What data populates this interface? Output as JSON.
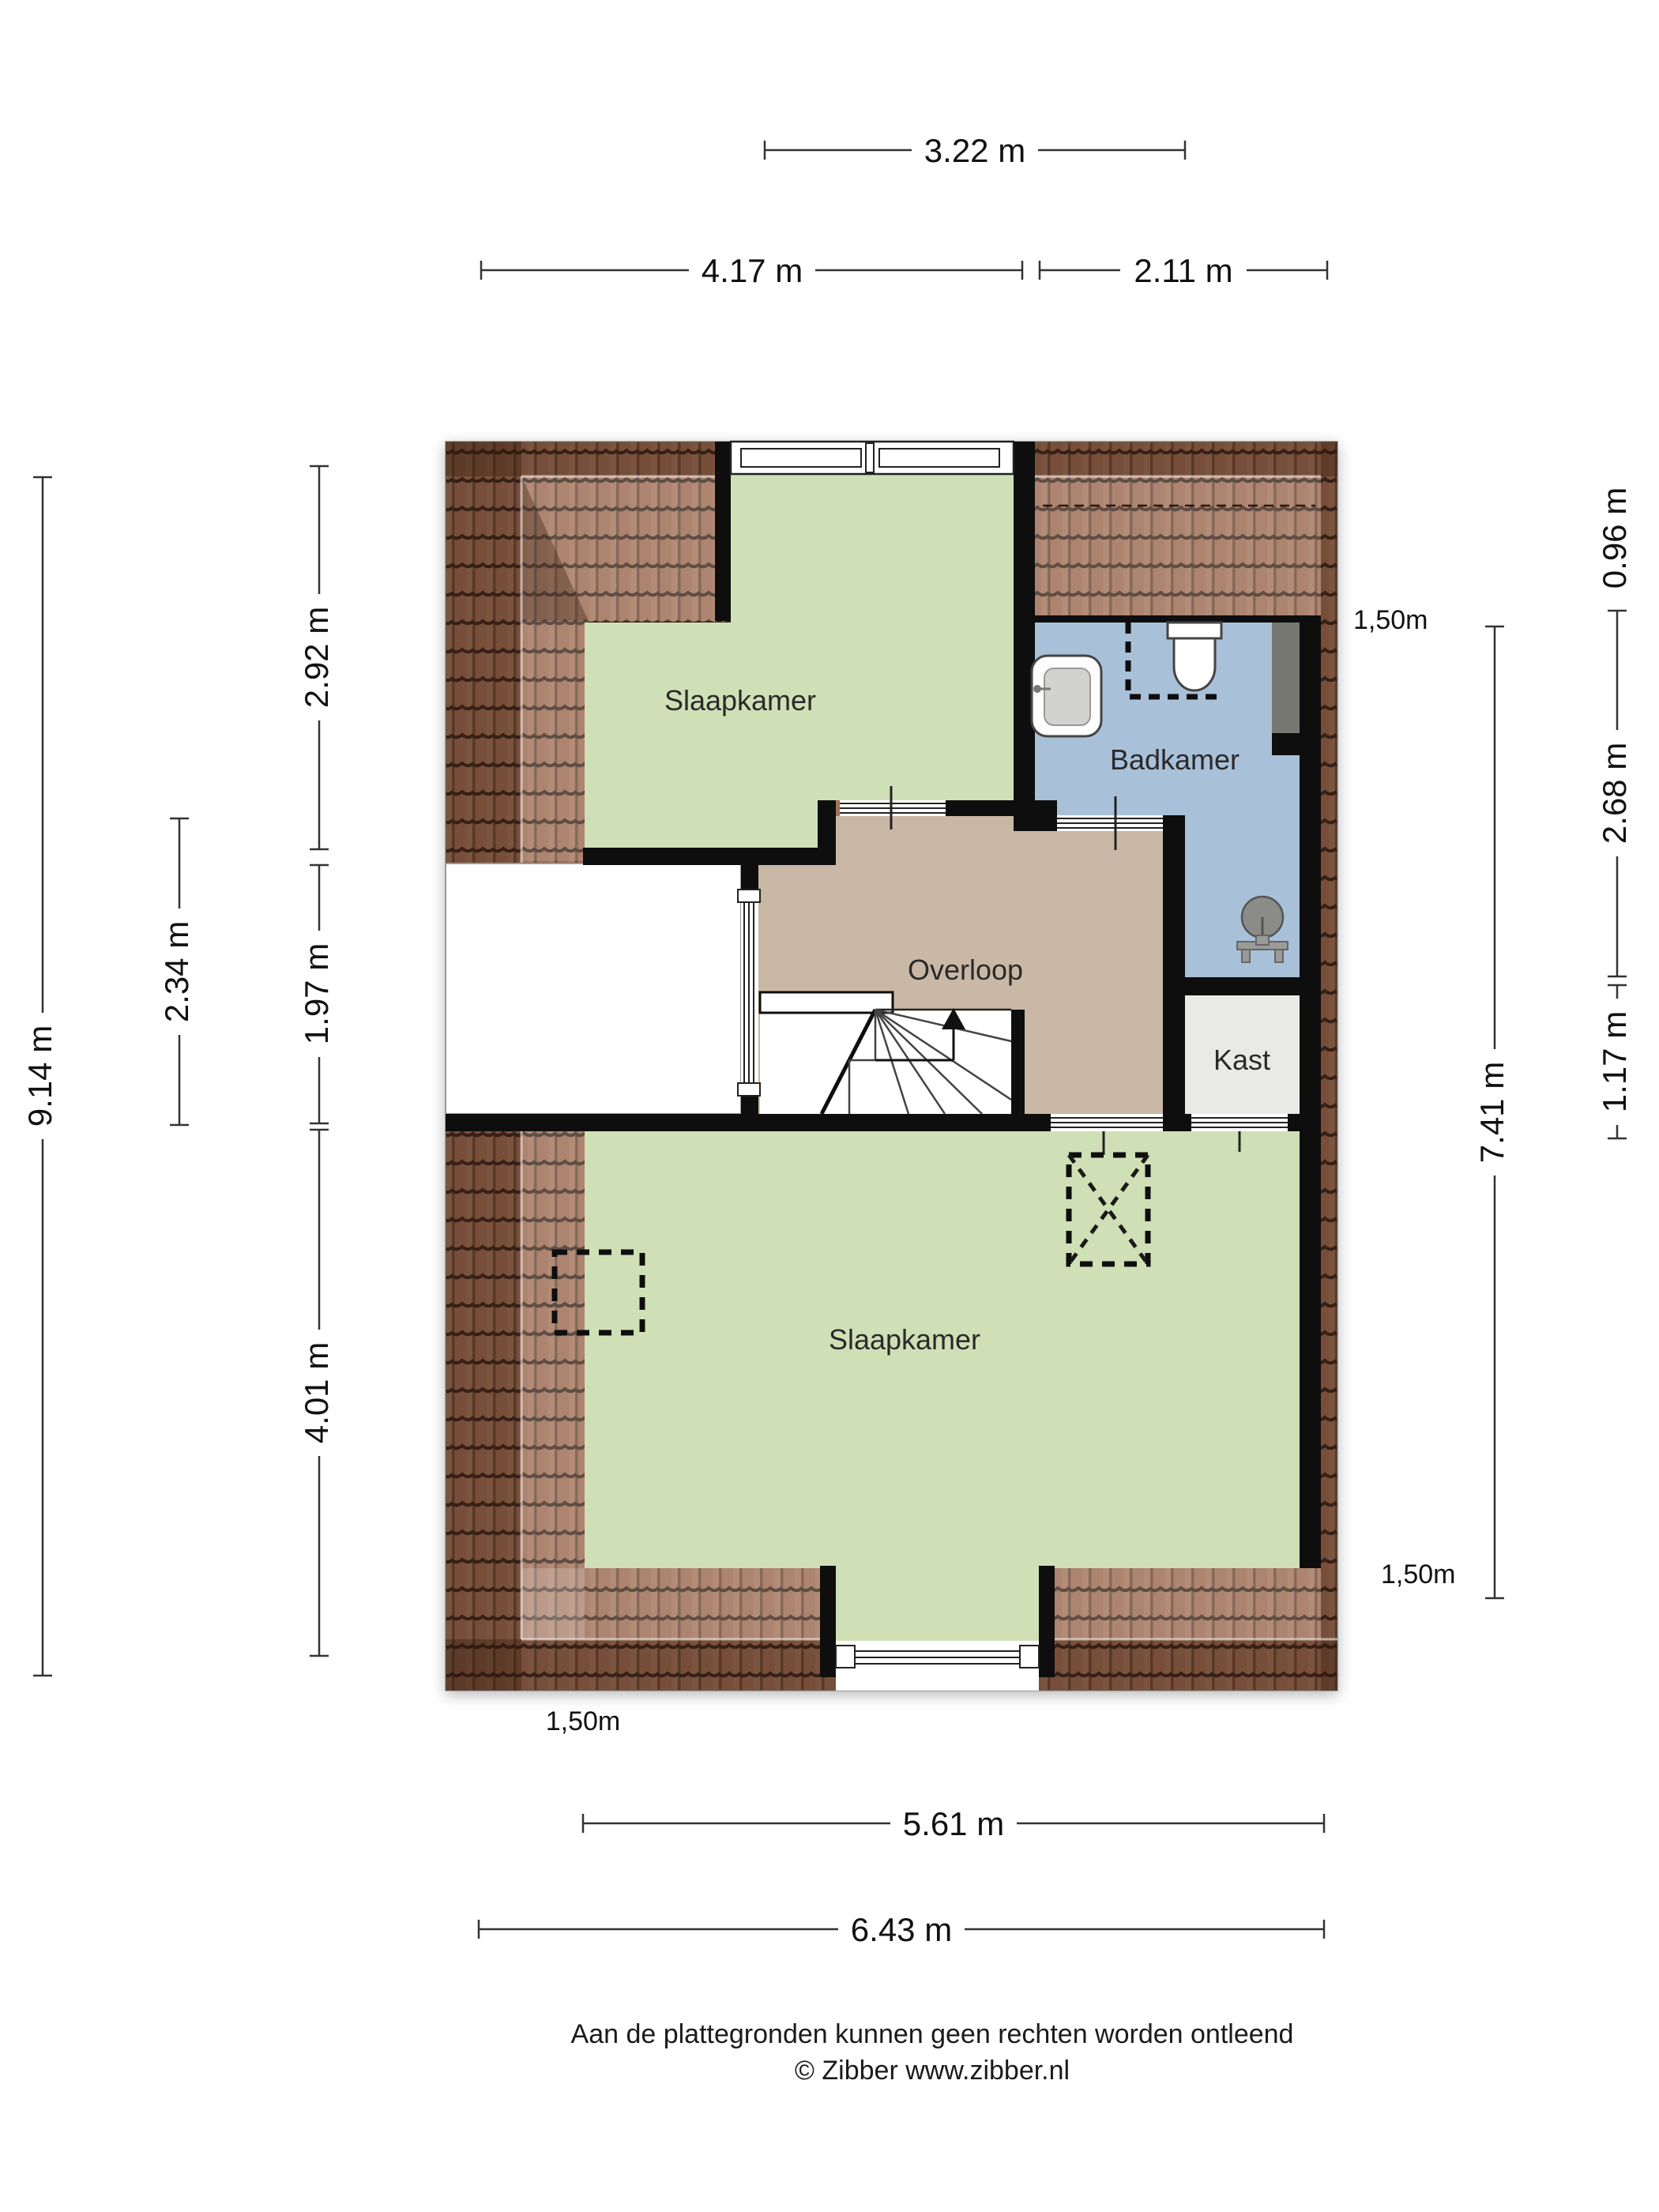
{
  "dimensions": {
    "horizontal": [
      "3.22 m",
      "4.17 m",
      "2.11 m",
      "5.61 m",
      "6.43 m"
    ],
    "vertical": [
      "9.14 m",
      "2.34 m",
      "2.92 m",
      "1.97 m",
      "4.01 m",
      "7.41 m",
      "0.96 m",
      "2.68 m",
      "1.17 m"
    ]
  },
  "rooms": [
    "Slaapkamer",
    "Badkamer",
    "Overloop",
    "Kast",
    "Slaapkamer"
  ],
  "height_labels": [
    "1,50m",
    "1,50m",
    "1,50m"
  ],
  "footer": {
    "line1": "Aan de plattegronden kunnen geen rechten worden ontleend",
    "line2": "© Zibber www.zibber.nl"
  },
  "icons": {
    "toilet": "toilet-icon",
    "sink": "sink-icon",
    "shower": "shower-icon",
    "stairs_arrow": "stairs-up-arrow-icon",
    "skylight": "skylight-dashed-icon",
    "recess": "dashed-recess-icon"
  },
  "colors": {
    "bedroom_green": "#cfe0b6",
    "bathroom_blue": "#a9c0d9",
    "hall_tan": "#c9b8a5",
    "closet_gray": "#e9e9e6",
    "roof_tile": "#9c6b51",
    "wall_black": "#0e0e0e",
    "duct_gray": "#787872"
  }
}
